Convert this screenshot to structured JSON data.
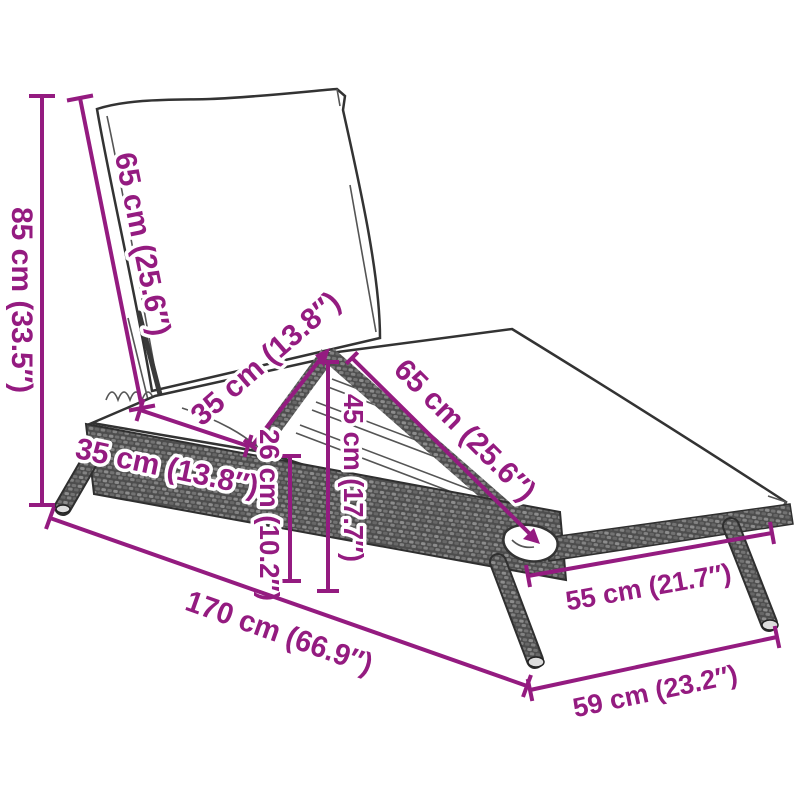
{
  "page": {
    "title": "Sun lounger dimension diagram",
    "background": "#ffffff"
  },
  "style": {
    "dimension_color": "#941b80",
    "line_art_color": "#333333"
  },
  "product": {
    "type": "poly-rattan sun lounger with cushion"
  },
  "dimensions": {
    "overall_height": "85 cm (33.5″)",
    "backrest_length": "65 cm (25.6″)",
    "seat_length": "35 cm (13.8″)",
    "seat_front_length": "35 cm (13.8″)",
    "seat_height": "26 cm (10.2″)",
    "knee_height": "45 cm (17.7″)",
    "legrest_length": "65 cm (25.6″)",
    "rear_section_width": "55 cm (21.7″)",
    "total_length": "170 cm (66.9″)",
    "base_width": "59 cm (23.2″)"
  }
}
